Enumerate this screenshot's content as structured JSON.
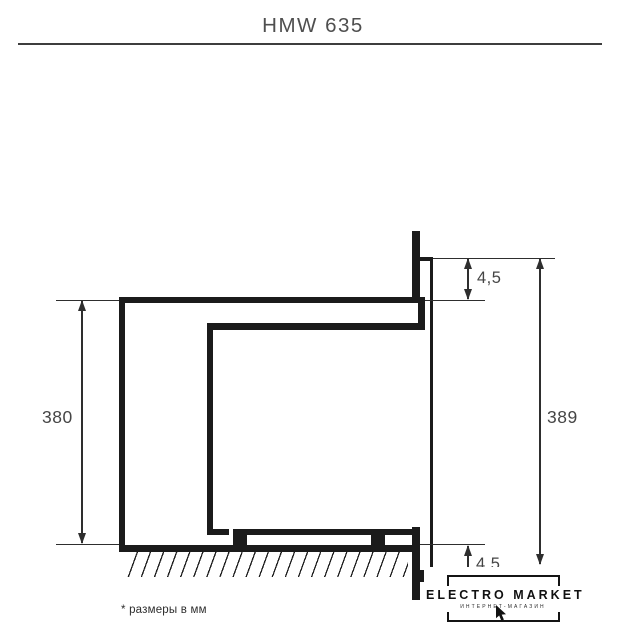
{
  "title": "HMW 635",
  "footnote": "* размеры в мм",
  "dimensions": {
    "left_height": "380",
    "right_height": "389",
    "top_gap": "4,5",
    "bottom_gap": "4,5"
  },
  "logo": {
    "title": "ELECTRO MARKET",
    "subtitle": "ИНТЕРНЕТ-МАГАЗИН"
  },
  "colors": {
    "drawing_line": "#1b1b1b",
    "dimension_line": "#2e2e2e",
    "title_text": "#4f4f4f",
    "label_text": "#454545",
    "background": "#ffffff"
  }
}
